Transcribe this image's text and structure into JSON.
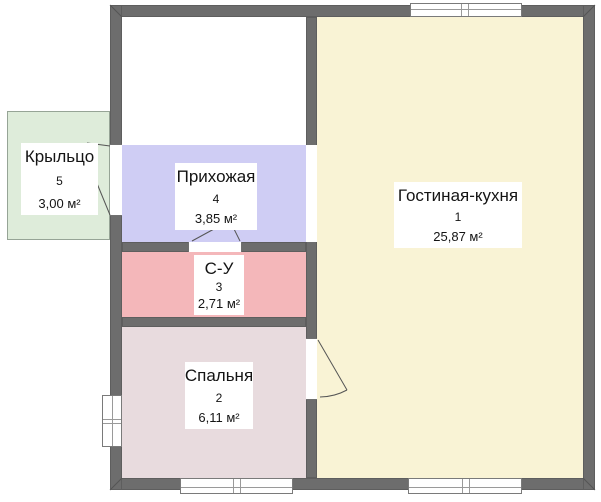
{
  "rooms": [
    {
      "key": "living-kitchen",
      "name": "Гостиная-кухня",
      "number": "1",
      "area": "25,87 м²",
      "color": "#f9f3d5"
    },
    {
      "key": "bedroom",
      "name": "Спальня",
      "number": "2",
      "area": "6,11 м²",
      "color": "#e8dbde"
    },
    {
      "key": "bathroom",
      "name": "С-У",
      "number": "3",
      "area": "2,71 м²",
      "color": "#f4b7ba"
    },
    {
      "key": "hallway",
      "name": "Прихожая",
      "number": "4",
      "area": "3,85 м²",
      "color": "#cfcdf4"
    },
    {
      "key": "porch",
      "name": "Крыльцо",
      "number": "5",
      "area": "3,00 м²",
      "color": "#deecda"
    }
  ],
  "unlabeled_room": {
    "color": "#ffffff"
  },
  "colors": {
    "wall": "#6d6d6d",
    "wall_outline": "#5e5e5e",
    "background": "#ffffff",
    "label_background": "#ffffff",
    "text": "#141414",
    "window_frame": "#7a7a7a",
    "door_line": "#555555",
    "porch_border": "#96a496"
  }
}
